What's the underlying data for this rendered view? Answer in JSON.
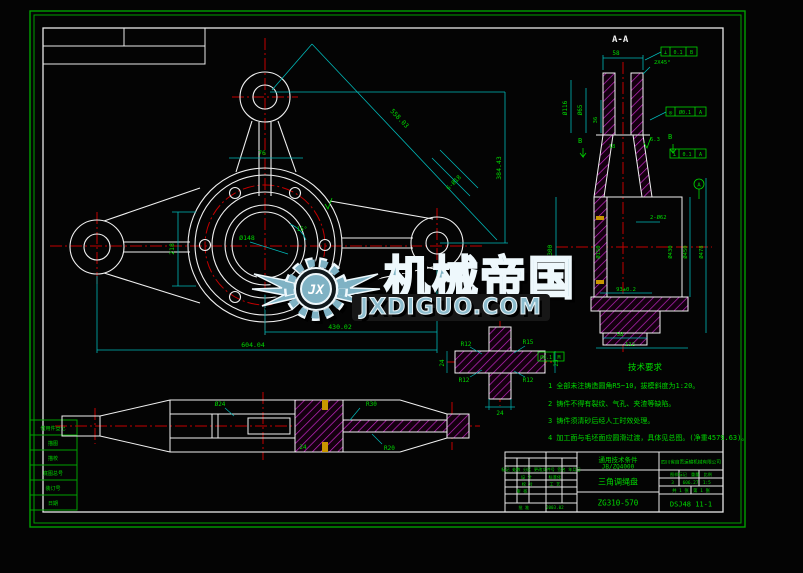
{
  "watermark": {
    "logo": "JX",
    "brand": "机械帝国",
    "site": "JXDIGUO.COM",
    "color": "#7fb2c4"
  },
  "tech": {
    "title": "技术要求",
    "l1": "1 全部未注铸造圆角R5~10，拔模斜度为1:20。",
    "l2": "2 铸件不得有裂纹、气孔、夹渣等缺陷。",
    "l3": "3 铸件须清砂后经人工时效处理。",
    "l4": "4 加工面与毛坯面应圆滑过渡，具体见总图。(净重4579.63)。",
    "tol_val": "Ø0.1",
    "tol_ref": "M"
  },
  "front": {
    "height": "384.43",
    "diag": "558.03",
    "center_right": "430.02",
    "overall": "604.04",
    "hub_h": "218",
    "top_w": "76",
    "bore": "Ø148",
    "angle": "15°",
    "holes": "6-Ø18"
  },
  "section": {
    "title": "A-A",
    "w58": "58",
    "chamfer": "2X45°",
    "d116": "Ø116",
    "d65": "Ø65",
    "d36": "36",
    "d18": "18",
    "rough": "6.3",
    "d300": "Ø300",
    "d150": "Ø150",
    "holes2": "2-Ø62",
    "d430": "Ø430",
    "d450": "Ø450",
    "d478": "Ø478",
    "tol93": "93±0.2",
    "b58": "58",
    "b112": "112",
    "datum": "A",
    "secb": "B",
    "f1": {
      "sym": "⊥",
      "val": "0.1",
      "ref": "B"
    },
    "f2": {
      "sym": "◎",
      "val": "Ø0.1",
      "ref": "A"
    },
    "f3": {
      "sym": "⊥",
      "val": "0.1",
      "ref": "A"
    }
  },
  "detail": {
    "r_tl": "R12",
    "r_tr": "R15",
    "r_bl": "R12",
    "r_br": "R12",
    "w": "24",
    "h": "24",
    "side": "25"
  },
  "bottom": {
    "r30": "R30",
    "r20": "R20",
    "d24": "24",
    "dia24": "Ø24"
  },
  "strip": {
    "items": [
      "借用件登记",
      "描图",
      "描校",
      "底图总号",
      "装订号",
      "日期"
    ]
  },
  "tb": {
    "std1": "通用技术条件",
    "std2": "JB/ZQ4000",
    "part": "三角调绳盘",
    "material": "ZG310-570",
    "company": "四川省自贡运输机械有限公司",
    "dwg": "DSJ48 11-1",
    "rev1": "标记 处数 分区 更改文件号 签名 年月日",
    "rev2": "设 计　　　　标准化",
    "rev3": "校 对　　　　工 艺",
    "rev4": "审 核",
    "rev5": "批 准　　　　2003.02",
    "mini_h": "图样标记　重量　比例",
    "mini_v": "3　　606.27　1:5",
    "sheets": "共 1 张　第 1 张"
  }
}
